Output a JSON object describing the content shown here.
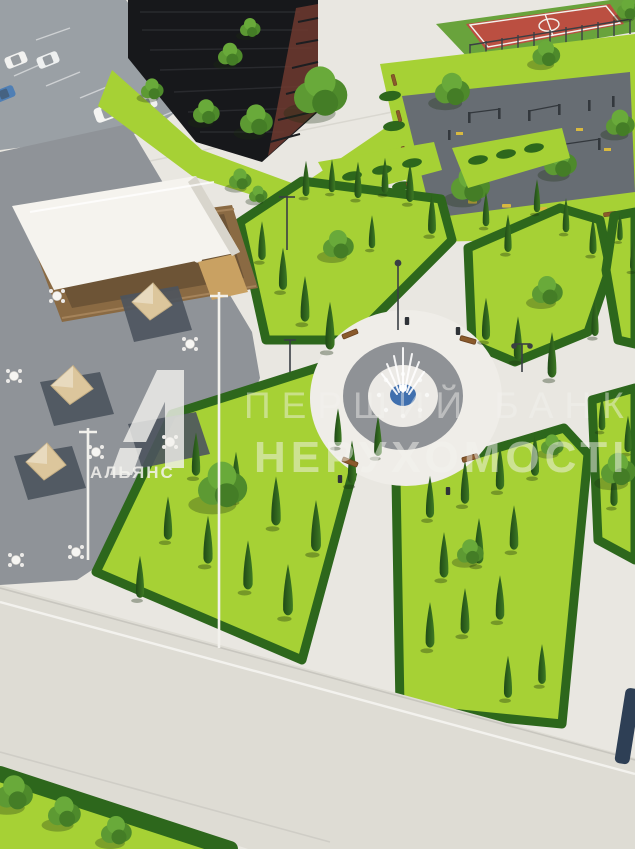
{
  "watermark": {
    "brand": "АЛЬЯНС",
    "line1": "ПЕРШИЙ БАНК",
    "line2": "НЕРУХОМОСТІ"
  },
  "palette": {
    "path": "#e9e7e1",
    "plaza": "#8f9398",
    "parking": "#9aa0a5",
    "road": "#dedcd4",
    "lawn": "#a6d135",
    "hedge": "#2d671c",
    "cypress_dark": "#1f4a16",
    "cypress_light": "#3e7a24",
    "tree_green": "#56942f",
    "building": "#17181b",
    "building_accent": "#6e3a2f",
    "court_red": "#bb4f41",
    "court_green": "#69a33c",
    "playground": "#676d73",
    "equipment_yellow": "#d8b93f",
    "canopy_white": "#f5f3ee",
    "wood": "#8a6a43",
    "wood_light": "#c9a162",
    "umbrella": "#dcc69c",
    "water_blue": "#3f6fae",
    "bench_brown": "#8a5a2c",
    "watermark_white": "#f4f3ef",
    "car_blue": "#4f7fb5",
    "car_dark": "#2e3338"
  }
}
